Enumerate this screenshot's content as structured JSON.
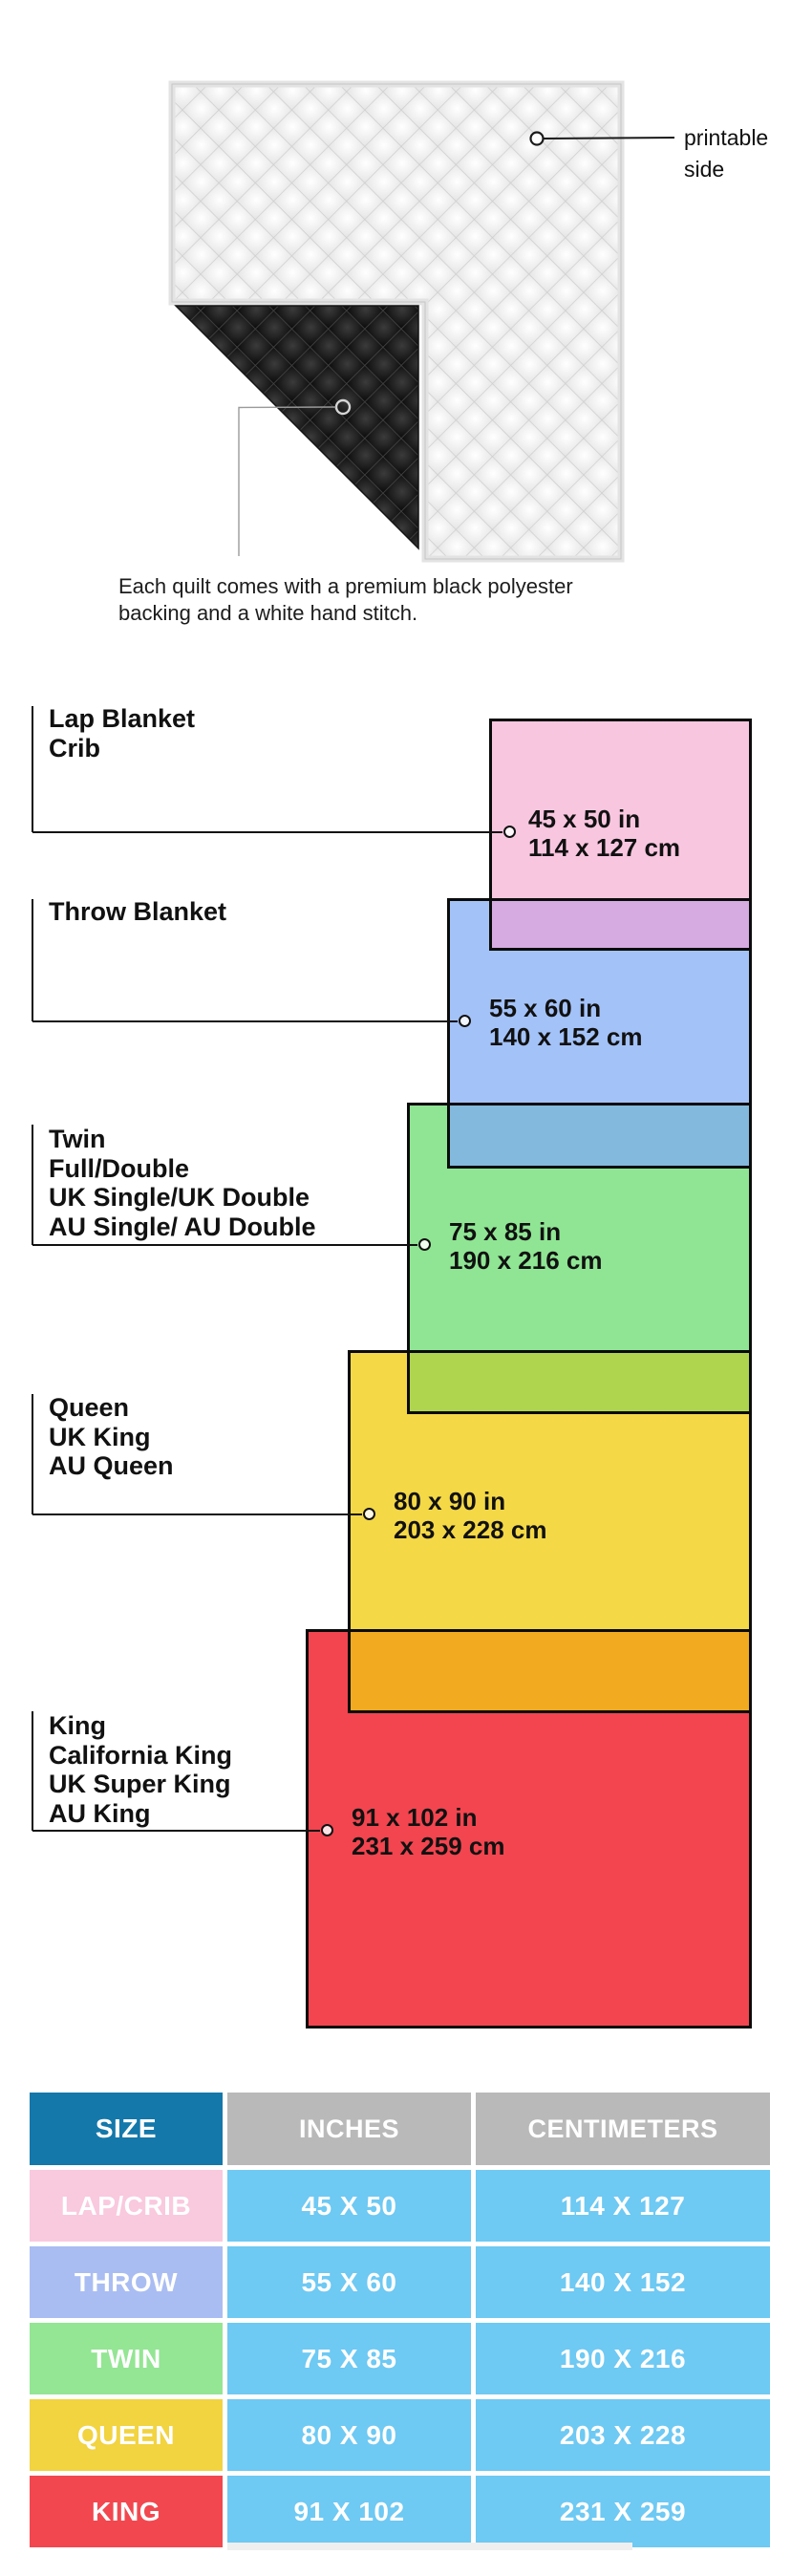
{
  "hero": {
    "printable_label_lines": [
      "printable",
      "side"
    ],
    "caption_lines": [
      "Each quilt comes with a premium black polyester",
      "backing and a white hand stitch."
    ]
  },
  "diagram": {
    "sections": [
      {
        "labels": [
          "Lap Blanket",
          "Crib"
        ],
        "inches": "45 x 50 in",
        "cm": "114 x 127 cm",
        "color": "#f9c6e0"
      },
      {
        "labels": [
          "Throw Blanket"
        ],
        "inches": "55 x 60 in",
        "cm": "140 x 152 cm",
        "color": "#a3c2f8"
      },
      {
        "labels": [
          "Twin",
          "Full/Double",
          "UK Single/UK Double",
          "AU Single/ AU Double"
        ],
        "inches": "75 x 85 in",
        "cm": "190 x 216 cm",
        "color": "#8fe593"
      },
      {
        "labels": [
          "Queen",
          "UK King",
          "AU Queen"
        ],
        "inches": "80 x 90 in",
        "cm": "203 x 228 cm",
        "color": "#f4d846"
      },
      {
        "labels": [
          "King",
          "California King",
          "UK Super King",
          "AU King"
        ],
        "inches": "91 x 102 in",
        "cm": "231 x 259 cm",
        "color": "#f2454f"
      }
    ],
    "overlap_colors": {
      "pink_over_blue": "#d5abe2",
      "green_over_blue": "#83b9dd",
      "green_over_yellow": "#aed54d",
      "yellow_over_red": "#f2aa20"
    },
    "outline_color": "#0b0b0b"
  },
  "table": {
    "headers": [
      "SIZE",
      "INCHES",
      "CENTIMETERS"
    ],
    "rows": [
      {
        "size": "LAP/CRIB",
        "inches": "45 X 50",
        "centimeters": "114 X 127",
        "color": "#f9c9de"
      },
      {
        "size": "THROW",
        "inches": "55 X 60",
        "centimeters": "140 X 152",
        "color": "#aabdf2"
      },
      {
        "size": "TWIN",
        "inches": "75 X 85",
        "centimeters": "190 X 216",
        "color": "#94e594"
      },
      {
        "size": "QUEEN",
        "inches": "80 X 90",
        "centimeters": "203 X 228",
        "color": "#f2d340"
      },
      {
        "size": "KING",
        "inches": "91 X 102",
        "centimeters": "231 X 259",
        "color": "#f2474f"
      }
    ],
    "header_size_bg": "#1478aa",
    "header_gray_bg": "#b9b9b9",
    "data_cell_bg": "#6ec9f3"
  }
}
